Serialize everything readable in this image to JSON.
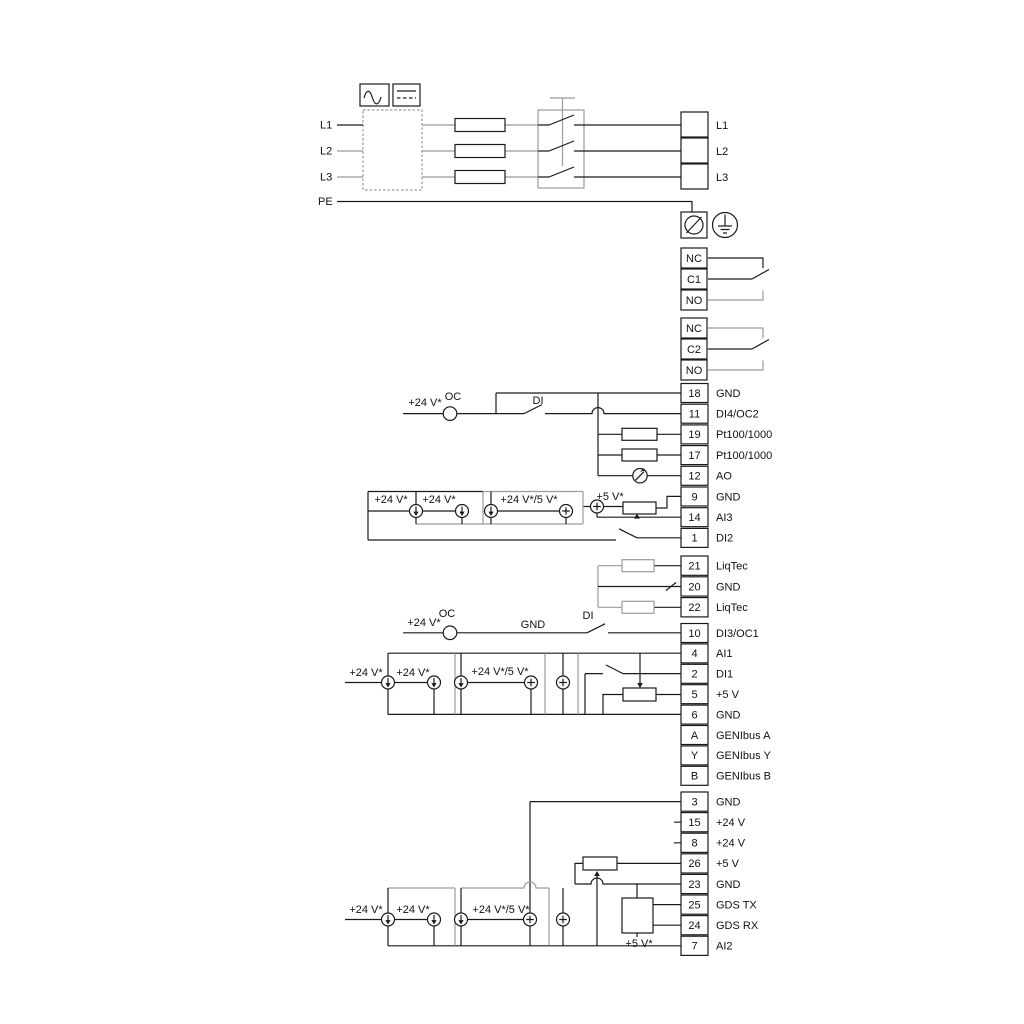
{
  "diagram": {
    "power": {
      "inputs": [
        "L1",
        "L2",
        "L3",
        "PE"
      ],
      "outputs": [
        "L1",
        "L2",
        "L3"
      ]
    },
    "relay1": [
      "NC",
      "C1",
      "NO"
    ],
    "relay2": [
      "NC",
      "C2",
      "NO"
    ],
    "io_top": [
      {
        "num": "18",
        "label": "GND"
      },
      {
        "num": "11",
        "label": "DI4/OC2"
      },
      {
        "num": "19",
        "label": "Pt100/1000"
      },
      {
        "num": "17",
        "label": "Pt100/1000"
      },
      {
        "num": "12",
        "label": "AO"
      },
      {
        "num": "9",
        "label": "GND"
      },
      {
        "num": "14",
        "label": "AI3"
      },
      {
        "num": "1",
        "label": "DI2"
      }
    ],
    "liqtec": [
      {
        "num": "21",
        "label": "LiqTec"
      },
      {
        "num": "20",
        "label": "GND"
      },
      {
        "num": "22",
        "label": "LiqTec"
      }
    ],
    "io_mid": [
      {
        "num": "10",
        "label": "DI3/OC1"
      },
      {
        "num": "4",
        "label": "AI1"
      },
      {
        "num": "2",
        "label": "DI1"
      },
      {
        "num": "5",
        "label": "+5 V"
      },
      {
        "num": "6",
        "label": "GND"
      },
      {
        "num": "A",
        "label": "GENIbus A"
      },
      {
        "num": "Y",
        "label": "GENIbus Y"
      },
      {
        "num": "B",
        "label": "GENIbus B"
      }
    ],
    "io_bottom": [
      {
        "num": "3",
        "label": "GND"
      },
      {
        "num": "15",
        "label": "+24 V"
      },
      {
        "num": "8",
        "label": "+24 V"
      },
      {
        "num": "26",
        "label": "+5 V"
      },
      {
        "num": "23",
        "label": "GND"
      },
      {
        "num": "25",
        "label": "GDS TX"
      },
      {
        "num": "24",
        "label": "GDS RX"
      },
      {
        "num": "7",
        "label": "AI2"
      }
    ],
    "ann_top": {
      "v24_a": "+24 V*",
      "oc": "OC",
      "di": "DI",
      "v24_b": "+24 V*",
      "v24_c": "+24 V*",
      "v24_5": "+24 V*/5 V*",
      "v5": "+5 V*"
    },
    "ann_mid": {
      "v24_a": "+24 V*",
      "oc": "OC",
      "gnd": "GND",
      "di": "DI",
      "v24_b": "+24 V*",
      "v24_c": "+24 V*",
      "v24_5": "+24 V*/5 V*"
    },
    "ann_bottom": {
      "v24_a": "+24 V*",
      "v24_b": "+24 V*",
      "v24_5": "+24 V*/5 V*",
      "v5": "+5 V*"
    },
    "colors": {
      "wire": "#1a1a1a",
      "wire_gray": "#9b9b9b",
      "background": "#ffffff"
    }
  }
}
